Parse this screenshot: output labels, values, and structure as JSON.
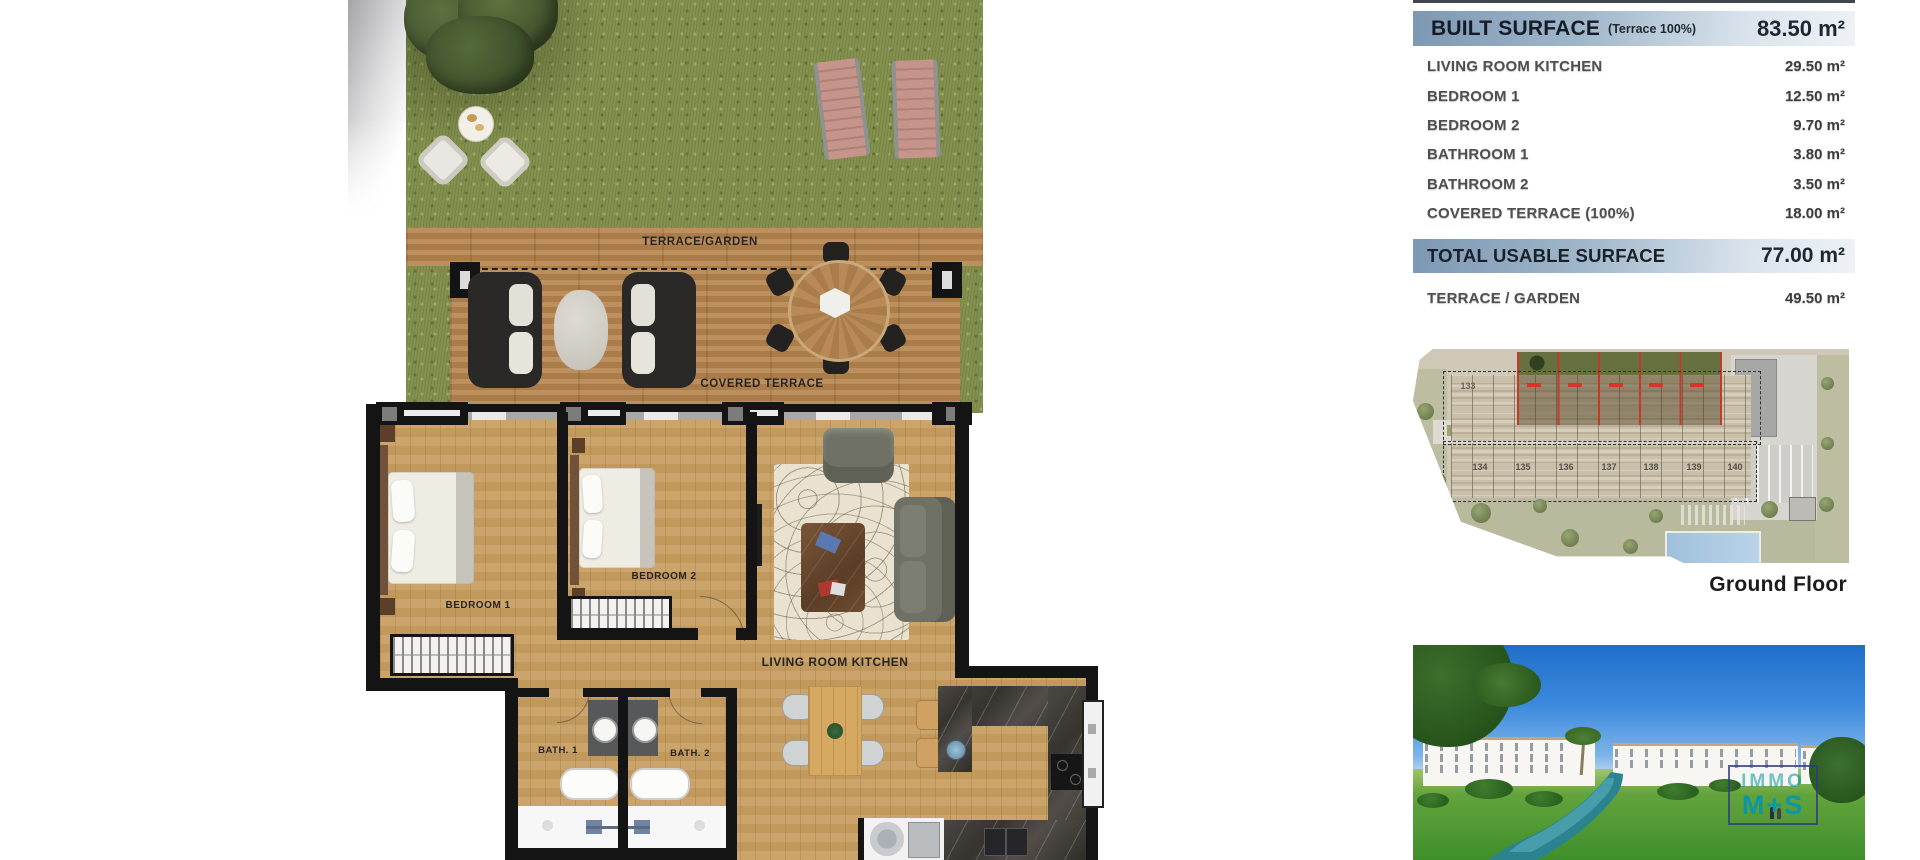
{
  "floorplan": {
    "labels": {
      "terrace_garden": "TERRACE/GARDEN",
      "covered_terrace": "COVERED TERRACE",
      "bedroom1": "BEDROOM 1",
      "bedroom2": "BEDROOM 2",
      "living_room_kitchen": "LIVING ROOM KITCHEN",
      "bath1": "BATH. 1",
      "bath2": "BATH. 2"
    }
  },
  "surface_table": {
    "header": {
      "label": "BUILT SURFACE",
      "note": "(Terrace 100%)",
      "value": "83.50 m²"
    },
    "rows": [
      {
        "label": "LIVING ROOM KITCHEN",
        "value": "29.50 m²"
      },
      {
        "label": "BEDROOM 1",
        "value": "12.50 m²"
      },
      {
        "label": "BEDROOM 2",
        "value": "9.70 m²"
      },
      {
        "label": "BATHROOM 1",
        "value": "3.80 m²"
      },
      {
        "label": "BATHROOM 2",
        "value": "3.50 m²"
      },
      {
        "label": "COVERED TERRACE (100%)",
        "value": "18.00 m²"
      }
    ],
    "total": {
      "label": "TOTAL USABLE SURFACE",
      "value": "77.00 m²"
    },
    "extra": {
      "label": "TERRACE / GARDEN",
      "value": "49.50 m²"
    }
  },
  "siteplan": {
    "caption": "Ground Floor",
    "unit_numbers": [
      "133",
      "134",
      "135",
      "136",
      "137",
      "138",
      "139",
      "140"
    ]
  },
  "photo": {
    "watermark_line1": "IMMO",
    "watermark_line2": "M+S"
  },
  "colors": {
    "table_band_blue": "#7d98b4",
    "highlight_red": "#c23b28",
    "watermark_teal": "#0b97a3",
    "grass_green": "#83904e",
    "deck_wood": "#b5854f",
    "floor_wood": "#c79e61",
    "pool_blue": "#a9c9e2"
  }
}
